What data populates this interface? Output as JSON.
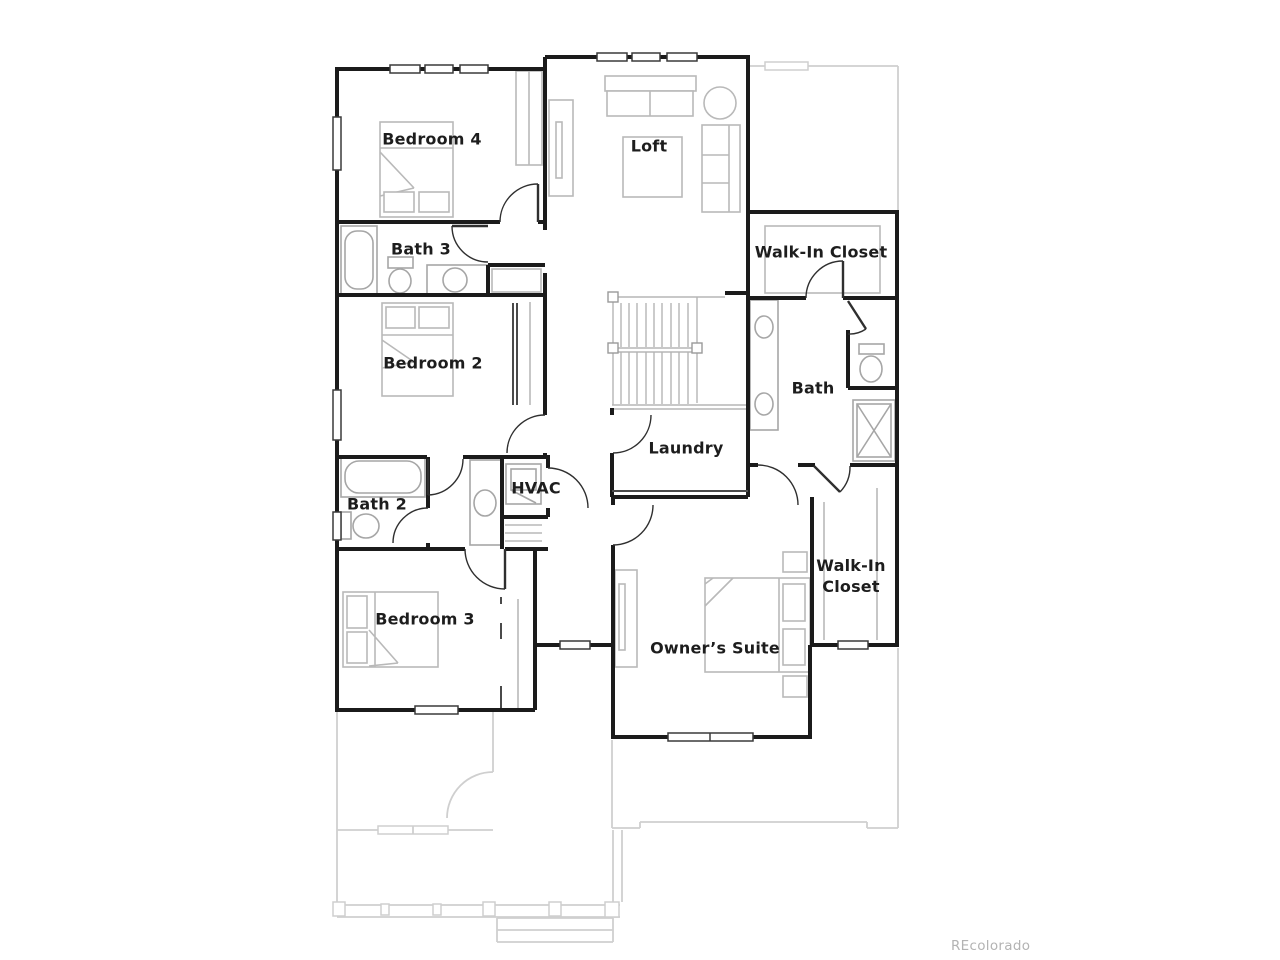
{
  "floorplan": {
    "labels": {
      "bedroom4": "Bedroom 4",
      "loft": "Loft",
      "bath3": "Bath 3",
      "wic1": "Walk-In Closet",
      "bedroom2": "Bedroom 2",
      "bath": "Bath",
      "laundry": "Laundry",
      "bath2": "Bath 2",
      "hvac": "HVAC",
      "bedroom3": "Bedroom 3",
      "wic2_line1": "Walk-In",
      "wic2_line2": "Closet",
      "owners_suite": "Owner’s Suite"
    },
    "watermark": "REcolorado",
    "colors": {
      "wall": "#1b1b1b",
      "door": "#2f2f2f",
      "furniture": "#b9b9b9",
      "fixture": "#a6a6a6",
      "stair": "#b5b5b5",
      "ghost": "#cfcfcf",
      "label": "#1d1d1d",
      "watermark": "#b3b3b3",
      "background": "#ffffff"
    }
  }
}
